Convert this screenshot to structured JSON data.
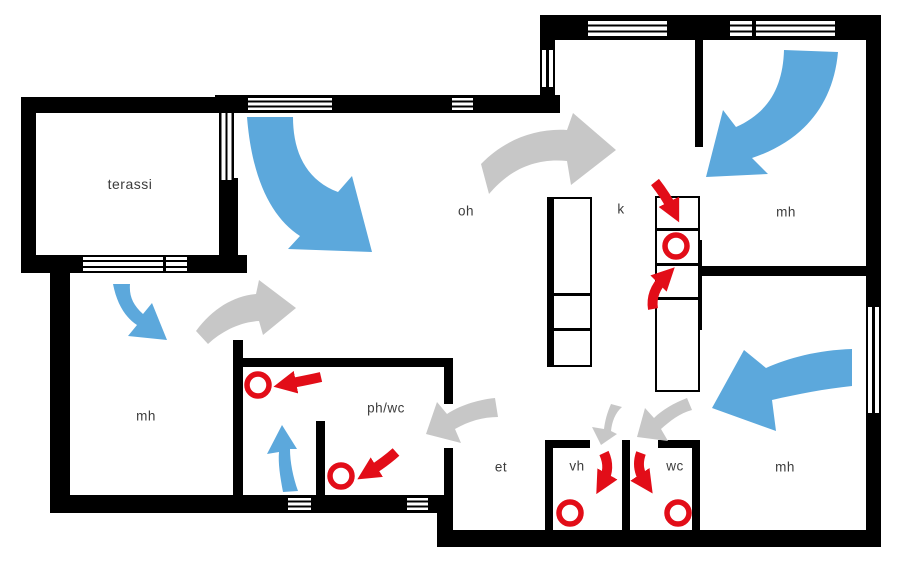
{
  "floor_plan": {
    "rooms": [
      {
        "id": "terassi",
        "label": "terassi"
      },
      {
        "id": "oh",
        "label": "oh"
      },
      {
        "id": "k",
        "label": "k"
      },
      {
        "id": "mh-top",
        "label": "mh"
      },
      {
        "id": "mh-left",
        "label": "mh"
      },
      {
        "id": "ph-wc",
        "label": "ph/wc"
      },
      {
        "id": "et",
        "label": "et"
      },
      {
        "id": "vh",
        "label": "vh"
      },
      {
        "id": "wc",
        "label": "wc"
      },
      {
        "id": "mh-right",
        "label": "mh"
      }
    ],
    "colors": {
      "supply_air": "#5ca8dc",
      "transfer_air": "#c7c7c7",
      "exhaust_air": "#e20d18",
      "walls": "#000000",
      "label_text": "#3c3c3c",
      "background": "#ffffff"
    },
    "airflow_elements": {
      "supply_arrow_count": 5,
      "transfer_arrow_count": 5,
      "exhaust_arrow_count": 6,
      "exhaust_valve_count": 5
    }
  }
}
